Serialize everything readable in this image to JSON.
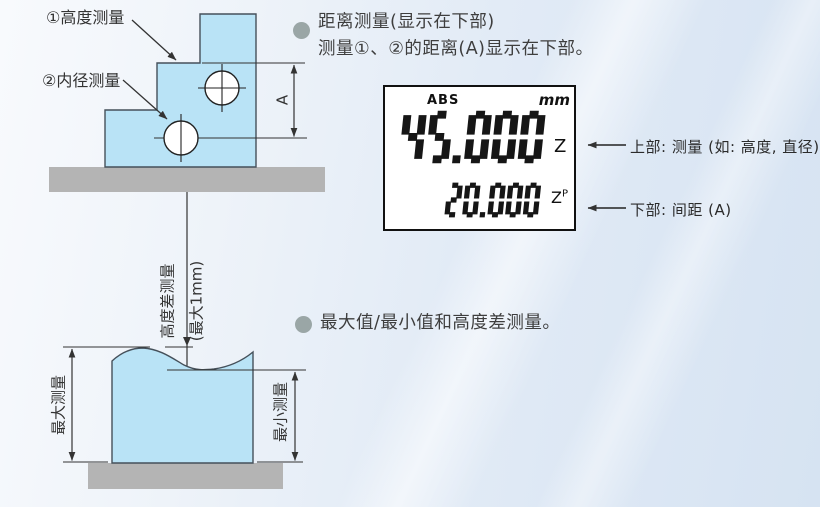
{
  "section1": {
    "line1": "距离测量(显示在下部)",
    "line2": "测量①、②的距离(A)显示在下部。"
  },
  "section2": {
    "line1": "最大值/最小值和高度差测量。"
  },
  "top_diagram": {
    "height_label": "①高度测量",
    "bore_label": "②内径测量",
    "dim_label": "A"
  },
  "bottom_diagram": {
    "probe_label": "高度差测量",
    "probe_label_note": "(最大1mm)",
    "max_label": "最大测量",
    "min_label": "最小测量"
  },
  "display": {
    "mode": "ABS",
    "unit": "mm",
    "main_value": "45.000",
    "main_axis": "Z",
    "sub_value": "20.000",
    "sub_axis": "Z",
    "sub_axis_sup": "P",
    "upper_label": "上部: 测量 (如: 高度, 直径)",
    "lower_label": "下部: 间距 (A)"
  },
  "colors": {
    "block_fill": "#b9e3f6",
    "base_fill": "#b4b4b4",
    "bullet_fill": "#9aa6a6",
    "line": "#333333",
    "digit": "#161616"
  }
}
